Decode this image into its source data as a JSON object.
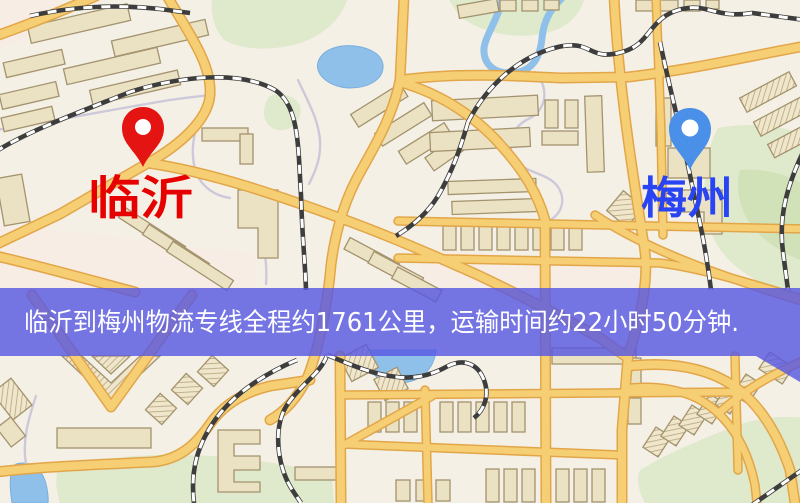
{
  "banner": {
    "text": "临沂到梅州物流专线全程约1761公里，运输时间约22小时50分钟.",
    "background_color": "#5858e2",
    "text_color": "#ffffff"
  },
  "markers": {
    "origin": {
      "label": "临沂",
      "pin_color": "#e31412",
      "label_color": "#e60000"
    },
    "destination": {
      "label": "梅州",
      "pin_color": "#4a90e8",
      "label_color": "#2944f2"
    }
  },
  "route_info": {
    "origin": "临沂",
    "destination": "梅州",
    "distance": "约1761公里",
    "duration": "约22小时50分钟"
  },
  "map": {
    "palette": {
      "background": "#f5f0e5",
      "road_fill": "#f6cf75",
      "road_casing": "#e2a649",
      "building": "#ebe2c4",
      "green_area": "#dfe9cc",
      "water": "#8fc0ea",
      "railway": "#3d3d3d"
    }
  }
}
